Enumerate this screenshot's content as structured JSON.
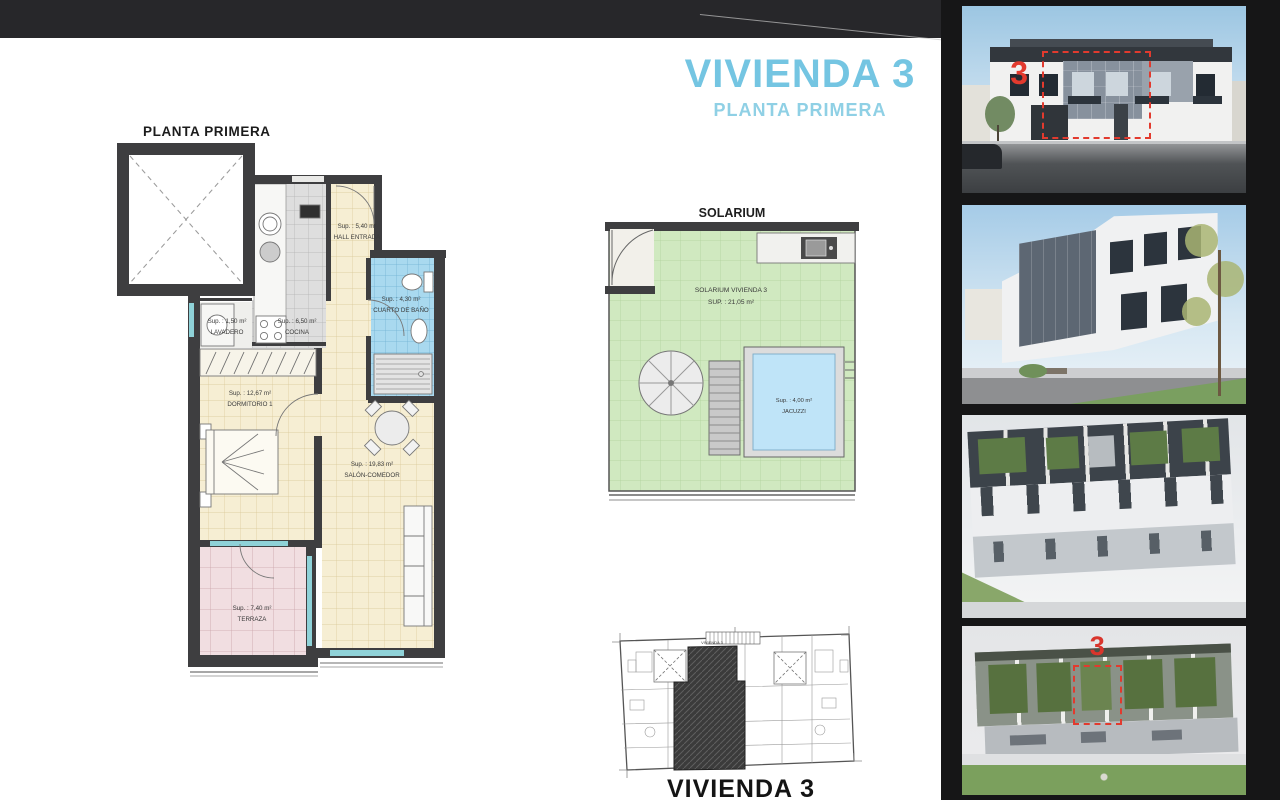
{
  "header": {
    "title": "VIVIENDA 3",
    "subtitle": "PLANTA PRIMERA"
  },
  "floor_plan": {
    "heading": "PLANTA PRIMERA",
    "rooms": {
      "hall": {
        "area": "Sup. : 5,40 m²",
        "name": "HALL ENTRADA"
      },
      "bano": {
        "area": "Sup. : 4,30 m²",
        "name": "CUARTO DE BAÑO"
      },
      "lavadero": {
        "area": "Sup. : 1,50 m²",
        "name": "LAVADERO"
      },
      "cocina": {
        "area": "Sup. : 6,50 m²",
        "name": "COCINA"
      },
      "dormitorio": {
        "area": "Sup. : 12,67 m²",
        "name": "DORMITORIO 1"
      },
      "salon": {
        "area": "Sup. : 19,83 m²",
        "name": "SALÓN-COMEDOR"
      },
      "terraza": {
        "area": "Sup. : 7,40 m²",
        "name": "TERRAZA"
      }
    }
  },
  "solarium": {
    "heading": "SOLARIUM",
    "label_line1": "SOLARIUM VIVIENDA 3",
    "label_line2": "SUP. : 21,05 m²",
    "jacuzzi": {
      "area": "Sup. : 4,00 m²",
      "name": "JACUZZI"
    }
  },
  "key_plan": {
    "unit_tag": "VIVIENDA 3",
    "caption": "VIVIENDA 3"
  },
  "photos": {
    "front_marker": "3",
    "top_marker": "3"
  },
  "colors": {
    "title_blue": "#74c5e2",
    "subtitle_blue": "#8fd0e5",
    "marker_red": "#e23a2e",
    "wall_dark": "#3e3e40",
    "floor_cream": "#f6eed3",
    "bath_blue": "#a9d9ef",
    "terrace_pink": "#f1dee1",
    "solarium_green": "#d0e9c0",
    "jacuzzi_blue": "#bfe4f8"
  }
}
